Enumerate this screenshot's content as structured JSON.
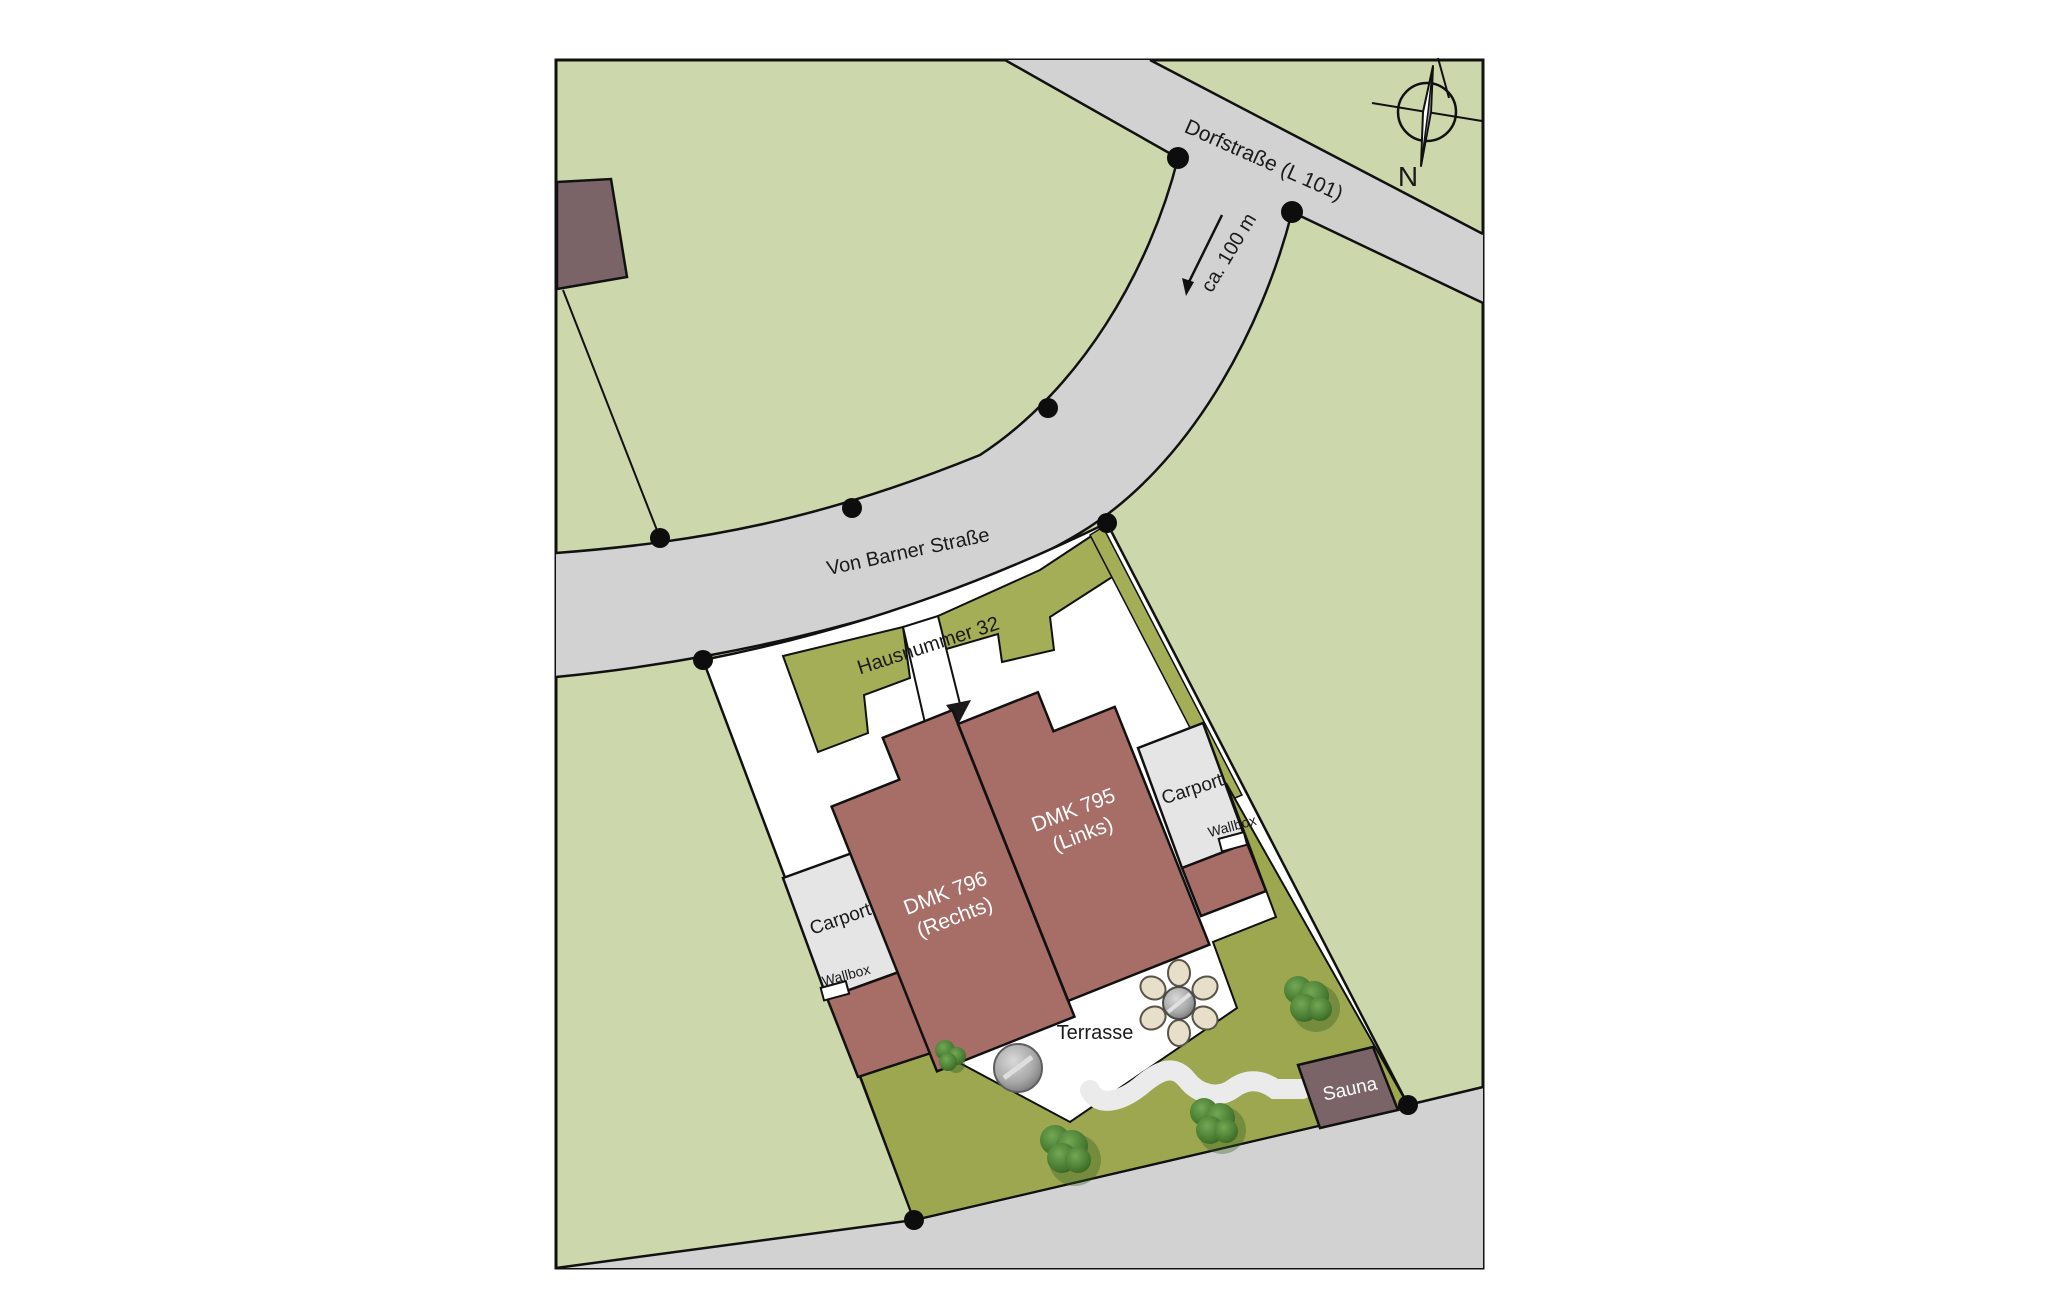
{
  "plan": {
    "streets": {
      "dorfstrasse": "Dorfstraße (L 101)",
      "von_barner": "Von Barner Straße",
      "distance_note": "ca. 100 m"
    },
    "address": "Hausnummer 32",
    "houses": {
      "right_unit": {
        "name": "DMK 796",
        "variant": "(Rechts)"
      },
      "left_unit": {
        "name": "DMK 795",
        "variant": "(Links)"
      }
    },
    "carport_left": "Carport",
    "carport_right": "Carport",
    "wallbox_left": "Wallbox",
    "wallbox_right": "Wallbox",
    "terrace": "Terrasse",
    "sauna": "Sauna",
    "compass_north": "N",
    "colors": {
      "lawn": "#ccd7ac",
      "road": "#d2d2d2",
      "garden_olive": "#a4ae57",
      "garden_olive_deep": "#9ca750",
      "house_red": "#a76e67",
      "building_mauve": "#7b6468",
      "carport_gray": "#e5e5e5",
      "plot_white": "#ffffff",
      "path_gray": "#ebebeb",
      "line_black": "#111111"
    }
  }
}
